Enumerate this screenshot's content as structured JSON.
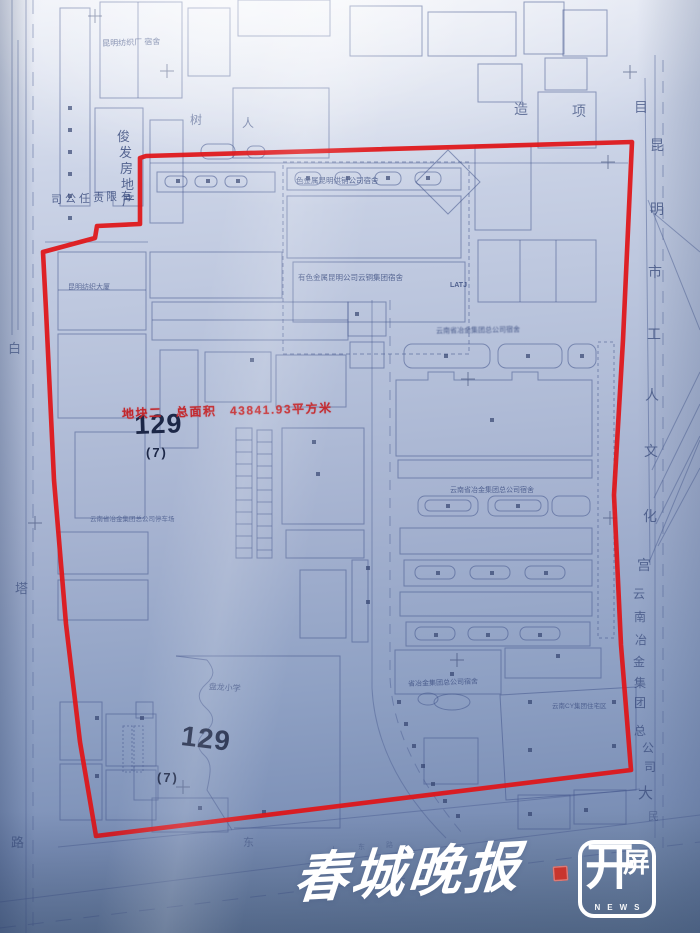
{
  "colors": {
    "boundary": "#e01418",
    "red_text": "#c2272c",
    "ink": "#4e5f94",
    "ink_dark": "#2d3c68"
  },
  "streets": {
    "left": [
      {
        "c": "白",
        "x": 8,
        "y": 342,
        "s": 13,
        "o": 0.65
      },
      {
        "c": "塔",
        "x": 15,
        "y": 582,
        "s": 13,
        "o": 0.65
      },
      {
        "c": "路",
        "x": 11,
        "y": 836,
        "s": 13,
        "o": 0.65
      }
    ],
    "bottom": [
      {
        "c": "东",
        "x": 243,
        "y": 838,
        "s": 11,
        "o": 0.5
      },
      {
        "c": "人",
        "x": 330,
        "y": 847,
        "s": 7,
        "o": 0.4
      },
      {
        "c": "东",
        "x": 358,
        "y": 844,
        "s": 7,
        "o": 0.4
      },
      {
        "c": "路",
        "x": 386,
        "y": 842,
        "s": 7,
        "o": 0.4
      },
      {
        "c": "民",
        "x": 648,
        "y": 812,
        "s": 11,
        "o": 0.5
      }
    ]
  },
  "top_chars": [
    {
      "c": "造",
      "x": 514,
      "y": 102,
      "s": 14,
      "o": 0.7
    },
    {
      "c": "项",
      "x": 572,
      "y": 104,
      "s": 14,
      "o": 0.7
    },
    {
      "c": "目",
      "x": 634,
      "y": 100,
      "s": 14,
      "o": 0.7
    }
  ],
  "right_chars": [
    {
      "c": "昆",
      "x": 650,
      "y": 138,
      "s": 14,
      "o": 0.75
    },
    {
      "c": "明",
      "x": 650,
      "y": 202,
      "s": 14,
      "o": 0.75
    },
    {
      "c": "市",
      "x": 648,
      "y": 265,
      "s": 14,
      "o": 0.75
    },
    {
      "c": "工",
      "x": 647,
      "y": 327,
      "s": 14,
      "o": 0.75
    },
    {
      "c": "人",
      "x": 645,
      "y": 388,
      "s": 14,
      "o": 0.75
    },
    {
      "c": "文",
      "x": 644,
      "y": 444,
      "s": 14,
      "o": 0.75
    },
    {
      "c": "化",
      "x": 643,
      "y": 509,
      "s": 14,
      "o": 0.75
    },
    {
      "c": "宫",
      "x": 637,
      "y": 558,
      "s": 14,
      "o": 0.75
    },
    {
      "c": "云",
      "x": 633,
      "y": 588,
      "s": 12,
      "o": 0.75
    },
    {
      "c": "南",
      "x": 634,
      "y": 611,
      "s": 12,
      "o": 0.75
    },
    {
      "c": "冶",
      "x": 635,
      "y": 634,
      "s": 12,
      "o": 0.75
    },
    {
      "c": "金",
      "x": 633,
      "y": 656,
      "s": 12,
      "o": 0.75
    },
    {
      "c": "集",
      "x": 634,
      "y": 677,
      "s": 12,
      "o": 0.75
    },
    {
      "c": "团",
      "x": 634,
      "y": 697,
      "s": 12,
      "o": 0.75
    },
    {
      "c": "总",
      "x": 634,
      "y": 725,
      "s": 12,
      "o": 0.75
    },
    {
      "c": "公",
      "x": 642,
      "y": 742,
      "s": 12,
      "o": 0.75
    },
    {
      "c": "司",
      "x": 644,
      "y": 761,
      "s": 12,
      "o": 0.75
    },
    {
      "c": "大",
      "x": 638,
      "y": 786,
      "s": 15,
      "o": 0.75
    }
  ],
  "developer": {
    "vertical": [
      {
        "c": "俊",
        "x": 117,
        "y": 130,
        "s": 13,
        "o": 0.8
      },
      {
        "c": "发",
        "x": 119,
        "y": 146,
        "s": 13,
        "o": 0.8
      },
      {
        "c": "房",
        "x": 120,
        "y": 162,
        "s": 13,
        "o": 0.8
      },
      {
        "c": "地",
        "x": 121,
        "y": 178,
        "s": 13,
        "o": 0.8
      },
      {
        "c": "产",
        "x": 122,
        "y": 194,
        "s": 13,
        "o": 0.8
      }
    ],
    "horizontal": [
      {
        "c": "司",
        "x": 51,
        "y": 195,
        "s": 11,
        "o": 0.8
      },
      {
        "c": "公",
        "x": 65,
        "y": 194,
        "s": 11,
        "o": 0.8
      },
      {
        "c": "任",
        "x": 79,
        "y": 194,
        "s": 11,
        "o": 0.8
      },
      {
        "c": "责",
        "x": 93,
        "y": 193,
        "s": 11,
        "o": 0.8
      },
      {
        "c": "限",
        "x": 106,
        "y": 192,
        "s": 11,
        "o": 0.8
      },
      {
        "c": "有",
        "x": 121,
        "y": 192,
        "s": 11,
        "o": 0.8
      }
    ]
  },
  "red_note": {
    "text": "地块二　总面积　43841.93平方米"
  },
  "parcels": [
    {
      "num": "129",
      "sub": "(7)",
      "nx": 134,
      "ny": 412,
      "ns": 27,
      "nrot": -2,
      "sx": 146,
      "sy": 446,
      "ss": 13
    },
    {
      "num": "129",
      "sub": "(7)",
      "nx": 183,
      "ny": 722,
      "ns": 28,
      "nrot": 7,
      "sx": 157,
      "sy": 771,
      "ss": 13
    }
  ],
  "labels": [
    {
      "text": "昆明纺织厂 宿舍",
      "x": 102,
      "y": 40,
      "s": 8,
      "rot": -2,
      "o": 0.75,
      "n": "label-kunming-textile-factory-dorm"
    },
    {
      "text": "树",
      "x": 190,
      "y": 114,
      "s": 12,
      "o": 0.6,
      "n": "label-shu"
    },
    {
      "text": "人",
      "x": 242,
      "y": 117,
      "s": 12,
      "o": 0.6,
      "n": "label-ren"
    },
    {
      "text": "色金属昆明供销公司宿舍",
      "x": 296,
      "y": 177,
      "s": 7.5,
      "o": 0.8,
      "n": "label-nonferrous-supply-company-dorm"
    },
    {
      "text": "有色金属昆明公司云铜集团宿舍",
      "x": 298,
      "y": 274,
      "s": 7.5,
      "o": 0.8,
      "n": "label-yuntong-group-dorm"
    },
    {
      "text": "昆明纺织大厦",
      "x": 68,
      "y": 284,
      "s": 7,
      "o": 0.75,
      "n": "label-kunming-textile-tower"
    },
    {
      "text": "云南省冶金集团总公司宿舍",
      "x": 436,
      "y": 328,
      "s": 7,
      "rot": -1,
      "o": 0.9,
      "blur": true,
      "n": "label-metallurgy-group-dorm-1"
    },
    {
      "text": "LATJ",
      "x": 450,
      "y": 282,
      "s": 7,
      "o": 0.85,
      "bold": true,
      "n": "label-latj-mark"
    },
    {
      "text": "云南省冶金集团总公司宿舍",
      "x": 450,
      "y": 487,
      "s": 7,
      "o": 0.8,
      "n": "label-metallurgy-group-dorm-2"
    },
    {
      "text": "云南省冶金集团总公司停车场",
      "x": 90,
      "y": 517,
      "s": 6.5,
      "o": 0.7,
      "n": "label-metallurgy-group-parking"
    },
    {
      "text": "省冶金集团总公司宿舍",
      "x": 408,
      "y": 681,
      "s": 7,
      "rot": -2,
      "o": 0.8,
      "n": "label-metallurgy-group-dorm-3"
    },
    {
      "text": "云南CY集团住宅区",
      "x": 552,
      "y": 704,
      "s": 6.5,
      "o": 0.75,
      "n": "label-cy-group-residential"
    },
    {
      "text": "盘龙小学",
      "x": 209,
      "y": 683,
      "s": 8,
      "rot": 4,
      "o": 0.8,
      "n": "label-panlong-primary-school"
    }
  ],
  "watermark": {
    "name": "春城晚报",
    "logo_kai": "开",
    "logo_ping": "屏",
    "news": "NEWS"
  }
}
